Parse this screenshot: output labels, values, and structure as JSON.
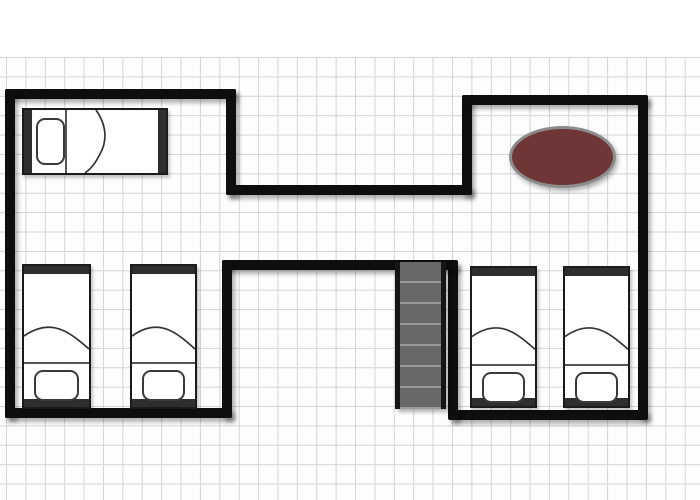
{
  "canvas": {
    "width_px": 700,
    "height_px": 500,
    "background": "#ffffff",
    "grid": {
      "visible": true,
      "cell_px": 19.4,
      "color": "#d4d4d4",
      "starts_below_top_band_px": 57
    }
  },
  "palette": {
    "wall": "#0e0e0e",
    "bed_fill": "#ffffff",
    "bed_outline": "#1b1b1b",
    "bed_frame_bar": "#2e2e2e",
    "stair_fill": "#686868",
    "stair_rail": "#161616",
    "stair_tread_line": "#9a9a9a",
    "rug_fill": "#6e3636",
    "rug_border": "#8d8d8d",
    "shadow": "rgba(0,0,0,0.3)"
  },
  "floorplan": {
    "shape": "H-shaped: left wing and right wing joined by a central corridor",
    "rooms": [
      {
        "id": "upper-left-room",
        "contents": [
          "single bed, horizontal, pillow at left"
        ]
      },
      {
        "id": "upper-right-room",
        "contents": [
          "maroon oval rug"
        ]
      },
      {
        "id": "lower-left-room",
        "contents": [
          "single bed, vertical, pillow at bottom",
          "single bed, vertical, pillow at bottom"
        ]
      },
      {
        "id": "lower-right-room",
        "contents": [
          "single bed, vertical, pillow at bottom",
          "single bed, vertical, pillow at bottom"
        ]
      }
    ],
    "furniture": [
      {
        "id": "bed-upper-left",
        "type": "single-bed",
        "orientation": "horizontal",
        "pillow_side": "left"
      },
      {
        "id": "bed-lower-left-1",
        "type": "single-bed",
        "orientation": "vertical",
        "pillow_side": "bottom"
      },
      {
        "id": "bed-lower-left-2",
        "type": "single-bed",
        "orientation": "vertical",
        "pillow_side": "bottom"
      },
      {
        "id": "bed-lower-right-1",
        "type": "single-bed",
        "orientation": "vertical",
        "pillow_side": "bottom"
      },
      {
        "id": "bed-lower-right-2",
        "type": "single-bed",
        "orientation": "vertical",
        "pillow_side": "bottom"
      },
      {
        "id": "oval-rug",
        "type": "rug",
        "shape": "ellipse"
      },
      {
        "id": "staircase",
        "type": "stairs",
        "treads_visible": 7,
        "location": "central corridor, descending below corridor wall"
      }
    ],
    "visible_text": []
  }
}
